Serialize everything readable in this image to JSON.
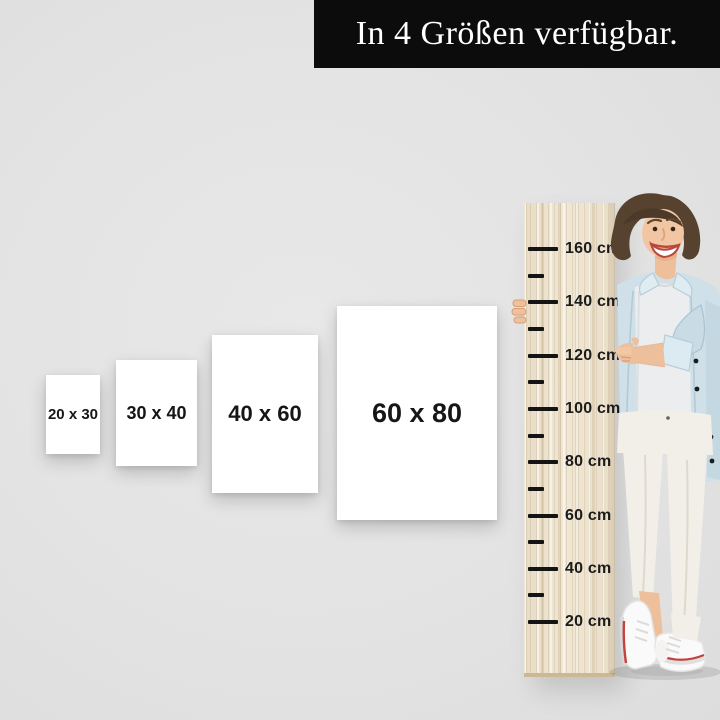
{
  "banner": {
    "text": "In 4 Größen verfügbar."
  },
  "sizes": [
    {
      "label": "20 x 30"
    },
    {
      "label": "30 x 40"
    },
    {
      "label": "40 x 60"
    },
    {
      "label": "60 x 80"
    }
  ],
  "ruler": {
    "unit": "cm",
    "marks": [
      "160 cm",
      "140 cm",
      "120 cm",
      "100 cm",
      "80 cm",
      "60 cm",
      "40 cm",
      "20 cm"
    ]
  },
  "colors": {
    "background": "#e3e3e3",
    "banner_bg": "#0c0c0c",
    "banner_text": "#ffffff",
    "card_bg": "#ffffff",
    "card_text": "#161616",
    "wood": "#ece1cb",
    "tick": "#141414",
    "denim_jacket": "#cfe0e8",
    "sneaker_stripe": "#c3433a"
  }
}
